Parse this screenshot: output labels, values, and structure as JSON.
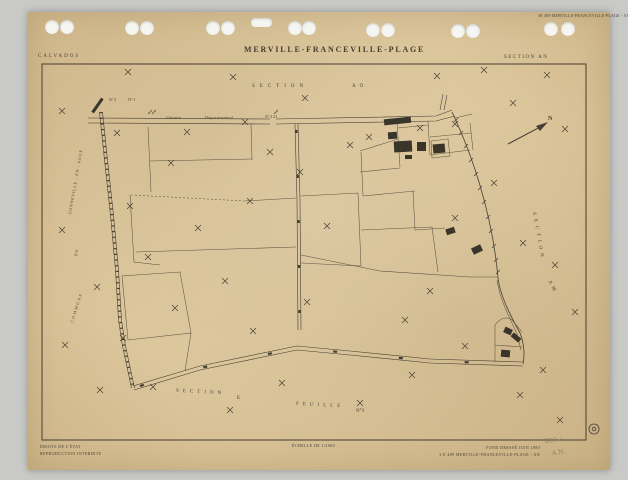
{
  "colors": {
    "background": "#c9c9c7",
    "paper": "#dcc69c",
    "ink": "#453e32",
    "pencil": "#8a7e66"
  },
  "stamp_top_right": "3E 489 MERVILLE-FRANCEVILLE-PLAGE - AN",
  "header": {
    "department": "CALVADOS",
    "title": "MERVILLE-FRANCEVILLE-PLAGE",
    "section": "SECTION AN"
  },
  "map": {
    "labels": {
      "section_top_word": "SECTION",
      "section_top_code": "AO",
      "section_right_word": "SECTION",
      "section_right_code": "AM",
      "section_bottom_word": "SECTION",
      "section_bottom_code": "E",
      "sheet_word": "FEUILLE",
      "sheet_code": "N°3",
      "commune_line1": "COMMUNE",
      "commune_line2": "DE",
      "commune_line3": "GONNEVILLE - EN - AUGE",
      "road_name_1": "Chemin",
      "road_name_2": "Départemental",
      "road_name_3": "N°223",
      "road_num_left": "N°2",
      "road_num_right": "N°1",
      "north_letter": "N"
    },
    "symbols": {
      "crosses": [
        [
          128,
          72
        ],
        [
          233,
          77
        ],
        [
          305,
          98
        ],
        [
          437,
          76
        ],
        [
          484,
          70
        ],
        [
          547,
          75
        ],
        [
          62,
          111
        ],
        [
          117,
          133
        ],
        [
          187,
          132
        ],
        [
          245,
          122
        ],
        [
          171,
          163
        ],
        [
          130,
          206
        ],
        [
          270,
          152
        ],
        [
          300,
          172
        ],
        [
          350,
          145
        ],
        [
          369,
          137
        ],
        [
          420,
          128
        ],
        [
          455,
          124
        ],
        [
          513,
          103
        ],
        [
          565,
          129
        ],
        [
          494,
          183
        ],
        [
          455,
          218
        ],
        [
          523,
          243
        ],
        [
          555,
          265
        ],
        [
          97,
          287
        ],
        [
          148,
          257
        ],
        [
          198,
          228
        ],
        [
          250,
          201
        ],
        [
          225,
          281
        ],
        [
          175,
          308
        ],
        [
          123,
          338
        ],
        [
          253,
          331
        ],
        [
          327,
          226
        ],
        [
          307,
          302
        ],
        [
          405,
          320
        ],
        [
          430,
          291
        ],
        [
          412,
          375
        ],
        [
          543,
          370
        ],
        [
          465,
          346
        ],
        [
          575,
          312
        ],
        [
          153,
          387
        ],
        [
          230,
          410
        ],
        [
          282,
          383
        ],
        [
          360,
          403
        ],
        [
          520,
          395
        ],
        [
          560,
          420
        ],
        [
          65,
          345
        ],
        [
          62,
          230
        ],
        [
          100,
          390
        ]
      ],
      "slashes": [
        [
          150,
          112
        ],
        [
          154,
          112
        ],
        [
          276,
          112
        ],
        [
          456,
          120
        ],
        [
          461,
          133
        ],
        [
          466,
          146
        ],
        [
          471,
          160
        ],
        [
          476,
          174
        ],
        [
          480,
          188
        ],
        [
          484,
          202
        ],
        [
          488,
          217
        ],
        [
          491,
          231
        ],
        [
          494,
          246
        ],
        [
          496,
          260
        ],
        [
          498,
          272
        ]
      ],
      "buildings": [
        {
          "x": 384,
          "y": 118,
          "w": 27,
          "h": 6,
          "r": -6
        },
        {
          "x": 388,
          "y": 132,
          "w": 9,
          "h": 7,
          "r": -4
        },
        {
          "x": 394,
          "y": 141,
          "w": 18,
          "h": 11,
          "r": -3
        },
        {
          "x": 417,
          "y": 142,
          "w": 9,
          "h": 9,
          "r": 0
        },
        {
          "x": 433,
          "y": 144,
          "w": 12,
          "h": 9,
          "r": -5
        },
        {
          "x": 405,
          "y": 155,
          "w": 7,
          "h": 4,
          "r": 0
        },
        {
          "x": 446,
          "y": 228,
          "w": 9,
          "h": 6,
          "r": -18
        },
        {
          "x": 472,
          "y": 246,
          "w": 10,
          "h": 7,
          "r": -25
        },
        {
          "x": 504,
          "y": 328,
          "w": 8,
          "h": 6,
          "r": 25
        },
        {
          "x": 511,
          "y": 335,
          "w": 10,
          "h": 5,
          "r": 40
        },
        {
          "x": 501,
          "y": 350,
          "w": 9,
          "h": 7,
          "r": 5
        },
        {
          "x": 96,
          "y": 97,
          "w": 3,
          "h": 17,
          "r": 35
        }
      ]
    }
  },
  "footer": {
    "left_line1": "DROITS DE L'ÉTAT",
    "left_line2": "REPRODUCTION INTERDITE",
    "scale": "ÉCHELLE DE 1/2000",
    "right_line1": "FOND DRESSÉ JUIN 1980",
    "right_line2": "3 E 489 MERVILLE-FRANCEVILLE-PLAGE - AN",
    "handwritten_1": "289 ✓",
    "handwritten_2": "A.N."
  }
}
